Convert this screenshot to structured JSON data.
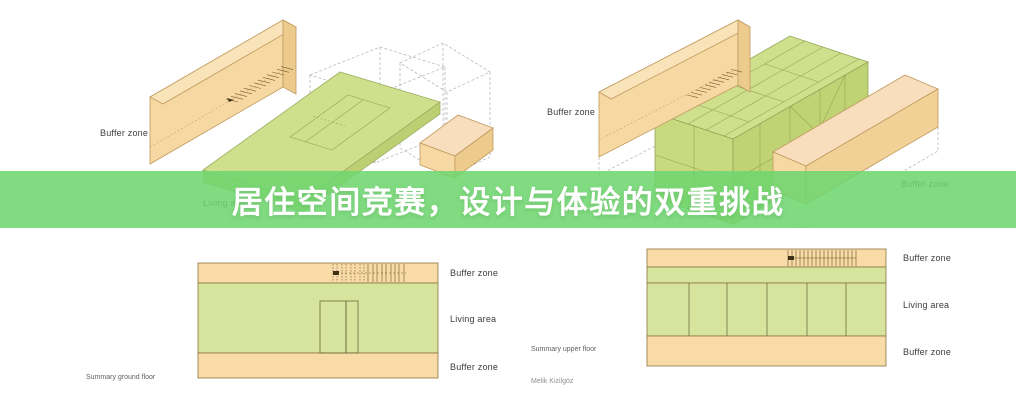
{
  "banner": {
    "title": "居住空间竞赛，设计与体验的双重挑战",
    "background_color": "#81db81",
    "text_color": "#ffffff"
  },
  "axon_ground": {
    "buffer_zone_label": "Buffer zone",
    "living_area_label": "Living area"
  },
  "axon_upper": {
    "buffer_zone_left_label": "Buffer zone",
    "buffer_zone_right_label": "Buffer zone"
  },
  "plan_ground": {
    "caption": "Summary ground floor",
    "zone_labels": [
      "Buffer zone",
      "Living area",
      "Buffer zone"
    ]
  },
  "plan_upper": {
    "caption": "Summary upper floor",
    "credit": "Melik Kizilgöz",
    "zone_labels": [
      "Buffer zone",
      "Living area",
      "Buffer zone"
    ]
  },
  "colors": {
    "buffer_orange": "#f6d8a2",
    "buffer_orange_top": "#f9e3b9",
    "buffer_orange_end": "#eccb8d",
    "living_green": "#cfe08d",
    "plan_orange": "#f8dba7",
    "plan_green": "#d6e49e",
    "banner_green": "#81db81"
  }
}
